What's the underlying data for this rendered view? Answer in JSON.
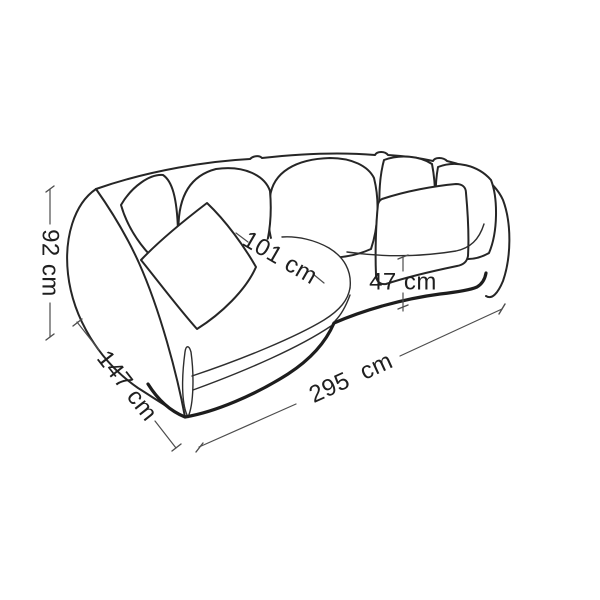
{
  "diagram": {
    "kind": "furniture-dimension-line-drawing",
    "subject": "curved corner sofa with back cushions and scatter pillows, outline sketch",
    "background_color": "#ffffff",
    "drawing_line_color": "#262626",
    "dimension_line_color": "#4d4d4d",
    "label_text_color": "#1f1f1f",
    "unit": "cm",
    "dimensions": {
      "overall_height": {
        "label": "92 cm",
        "value": 92
      },
      "left_side_depth": {
        "label": "147 cm",
        "value": 147
      },
      "seat_diagonal": {
        "label": "101 cm",
        "value": 101
      },
      "seat_height": {
        "label": "47 cm",
        "value": 47
      },
      "overall_width": {
        "label": "295 cm",
        "value": 295
      }
    }
  }
}
